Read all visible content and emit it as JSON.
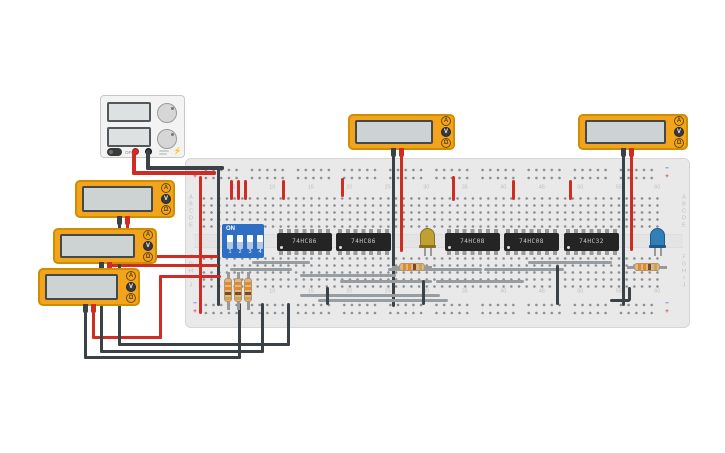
{
  "colors": {
    "wire_red": "#cf2d24",
    "wire_black": "#3a4247",
    "wire_gray": "#989da1",
    "board": "#e9e9e9",
    "meter_body": "#f2a41d",
    "dip_blue": "#2e6fc4",
    "rail_minus": "#4a74c9",
    "rail_plus": "#d24a43",
    "led_yellow": "#bfa131",
    "led_blue": "#2f80b9"
  },
  "icons": {
    "lightning": "⚡",
    "ohm": "Ω"
  },
  "power_supply": {
    "power_label": "OFF"
  },
  "multimeter_buttons": [
    "A",
    "V",
    "Ω"
  ],
  "multimeters": [
    {
      "id": "multimeter-left-1",
      "x": 75,
      "y": 180,
      "w": 100,
      "h": 38,
      "mode": "V",
      "probe_black_x": 118,
      "probe_red_x": 126
    },
    {
      "id": "multimeter-left-2",
      "x": 53,
      "y": 228,
      "w": 104,
      "h": 36,
      "mode": "V",
      "probe_black_x": 100,
      "probe_red_x": 108
    },
    {
      "id": "multimeter-left-3",
      "x": 38,
      "y": 268,
      "w": 102,
      "h": 38,
      "mode": "V",
      "probe_black_x": 84,
      "probe_red_x": 92
    },
    {
      "id": "multimeter-top-1",
      "x": 348,
      "y": 114,
      "w": 107,
      "h": 36,
      "mode": "V",
      "probe_black_x": 392,
      "probe_red_x": 400
    },
    {
      "id": "multimeter-top-2",
      "x": 578,
      "y": 114,
      "w": 110,
      "h": 36,
      "mode": "V",
      "probe_black_x": 622,
      "probe_red_x": 630
    }
  ],
  "breadboard": {
    "row_labels_top": [
      "A",
      "B",
      "C",
      "D",
      "E"
    ],
    "row_labels_bottom": [
      "F",
      "G",
      "H",
      "I",
      "J"
    ],
    "column_numbers": [
      5,
      10,
      15,
      20,
      25,
      30,
      35,
      40,
      45,
      50,
      55,
      60
    ],
    "rail_labels": {
      "plus": "+",
      "minus": "−"
    }
  },
  "dip_switch": {
    "on_label": "ON",
    "switch_labels": [
      "1",
      "2",
      "3",
      "4"
    ],
    "states": [
      "on",
      "on",
      "on",
      "on"
    ]
  },
  "ics": [
    {
      "label": "74HC86",
      "x": 277,
      "y": 233,
      "w": 55
    },
    {
      "label": "74HC86",
      "x": 336,
      "y": 233,
      "w": 55
    },
    {
      "label": "74HC08",
      "x": 445,
      "y": 233,
      "w": 55
    },
    {
      "label": "74HC08",
      "x": 504,
      "y": 233,
      "w": 55
    },
    {
      "label": "74HC32",
      "x": 564,
      "y": 233,
      "w": 55
    }
  ],
  "leds": [
    {
      "color": "yellow",
      "x": 420,
      "y": 228
    },
    {
      "color": "blue",
      "x": 650,
      "y": 228
    }
  ],
  "resistors": {
    "band_colors": [
      "#e6891f",
      "#e6891f",
      "#7a4b22",
      "#caa64c"
    ],
    "horizontal": [
      {
        "x": 392,
        "y": 263
      },
      {
        "x": 627,
        "y": 263
      }
    ],
    "vertical": [
      {
        "x": 224,
        "y": 272
      },
      {
        "x": 234,
        "y": 272
      },
      {
        "x": 244,
        "y": 272
      }
    ]
  },
  "wires": [
    {
      "c": "red",
      "x": 132,
      "y": 150,
      "w": 4,
      "h": 24
    },
    {
      "c": "red",
      "x": 132,
      "y": 171,
      "w": 84,
      "h": 4
    },
    {
      "c": "black",
      "x": 146,
      "y": 150,
      "w": 4,
      "h": 19
    },
    {
      "c": "black",
      "x": 146,
      "y": 166,
      "w": 78,
      "h": 4
    },
    {
      "c": "red",
      "x": 199,
      "y": 176,
      "w": 3,
      "h": 138
    },
    {
      "c": "black",
      "x": 217,
      "y": 168,
      "w": 3,
      "h": 138
    },
    {
      "c": "red",
      "x": 230,
      "y": 180,
      "w": 3,
      "h": 20
    },
    {
      "c": "red",
      "x": 237,
      "y": 180,
      "w": 3,
      "h": 20
    },
    {
      "c": "red",
      "x": 244,
      "y": 180,
      "w": 3,
      "h": 20
    },
    {
      "c": "red",
      "x": 282,
      "y": 180,
      "w": 3,
      "h": 20
    },
    {
      "c": "red",
      "x": 341,
      "y": 178,
      "w": 3,
      "h": 19
    },
    {
      "c": "red",
      "x": 452,
      "y": 176,
      "w": 3,
      "h": 25
    },
    {
      "c": "red",
      "x": 512,
      "y": 180,
      "w": 3,
      "h": 20
    },
    {
      "c": "red",
      "x": 569,
      "y": 180,
      "w": 3,
      "h": 20
    },
    {
      "c": "black",
      "x": 392,
      "y": 146,
      "w": 3,
      "h": 161
    },
    {
      "c": "red",
      "x": 400,
      "y": 146,
      "w": 3,
      "h": 106
    },
    {
      "c": "black",
      "x": 622,
      "y": 146,
      "w": 3,
      "h": 160
    },
    {
      "c": "red",
      "x": 630,
      "y": 146,
      "w": 3,
      "h": 105
    },
    {
      "c": "red",
      "x": 126,
      "y": 220,
      "w": 3,
      "h": 38
    },
    {
      "c": "red",
      "x": 126,
      "y": 255,
      "w": 92,
      "h": 3
    },
    {
      "c": "red",
      "x": 108,
      "y": 264,
      "w": 110,
      "h": 3
    },
    {
      "c": "red",
      "x": 92,
      "y": 306,
      "w": 3,
      "h": 33
    },
    {
      "c": "red",
      "x": 92,
      "y": 336,
      "w": 70,
      "h": 3
    },
    {
      "c": "red",
      "x": 159,
      "y": 275,
      "w": 3,
      "h": 64
    },
    {
      "c": "red",
      "x": 159,
      "y": 275,
      "w": 62,
      "h": 3
    },
    {
      "c": "black",
      "x": 118,
      "y": 220,
      "w": 3,
      "h": 126
    },
    {
      "c": "black",
      "x": 118,
      "y": 343,
      "w": 172,
      "h": 3
    },
    {
      "c": "black",
      "x": 287,
      "y": 303,
      "w": 3,
      "h": 43
    },
    {
      "c": "black",
      "x": 100,
      "y": 264,
      "w": 3,
      "h": 89
    },
    {
      "c": "black",
      "x": 100,
      "y": 350,
      "w": 164,
      "h": 3
    },
    {
      "c": "black",
      "x": 261,
      "y": 303,
      "w": 3,
      "h": 50
    },
    {
      "c": "black",
      "x": 84,
      "y": 306,
      "w": 3,
      "h": 53
    },
    {
      "c": "black",
      "x": 84,
      "y": 356,
      "w": 157,
      "h": 3
    },
    {
      "c": "black",
      "x": 238,
      "y": 303,
      "w": 3,
      "h": 56
    },
    {
      "c": "gray",
      "x": 252,
      "y": 261,
      "w": 58,
      "h": 3
    },
    {
      "c": "gray",
      "x": 230,
      "y": 268,
      "w": 62,
      "h": 3
    },
    {
      "c": "gray",
      "x": 300,
      "y": 274,
      "w": 96,
      "h": 3
    },
    {
      "c": "gray",
      "x": 340,
      "y": 280,
      "w": 92,
      "h": 3
    },
    {
      "c": "gray",
      "x": 388,
      "y": 268,
      "w": 94,
      "h": 3
    },
    {
      "c": "gray",
      "x": 436,
      "y": 280,
      "w": 88,
      "h": 3
    },
    {
      "c": "gray",
      "x": 484,
      "y": 268,
      "w": 80,
      "h": 3
    },
    {
      "c": "gray",
      "x": 528,
      "y": 261,
      "w": 84,
      "h": 3
    },
    {
      "c": "gray",
      "x": 300,
      "y": 294,
      "w": 140,
      "h": 3
    },
    {
      "c": "gray",
      "x": 318,
      "y": 299,
      "w": 130,
      "h": 3
    },
    {
      "c": "black",
      "x": 326,
      "y": 287,
      "w": 3,
      "h": 18
    },
    {
      "c": "black",
      "x": 422,
      "y": 280,
      "w": 3,
      "h": 25
    },
    {
      "c": "black",
      "x": 556,
      "y": 265,
      "w": 3,
      "h": 40
    },
    {
      "c": "black",
      "x": 610,
      "y": 299,
      "w": 20,
      "h": 3
    },
    {
      "c": "black",
      "x": 628,
      "y": 287,
      "w": 3,
      "h": 14
    }
  ]
}
